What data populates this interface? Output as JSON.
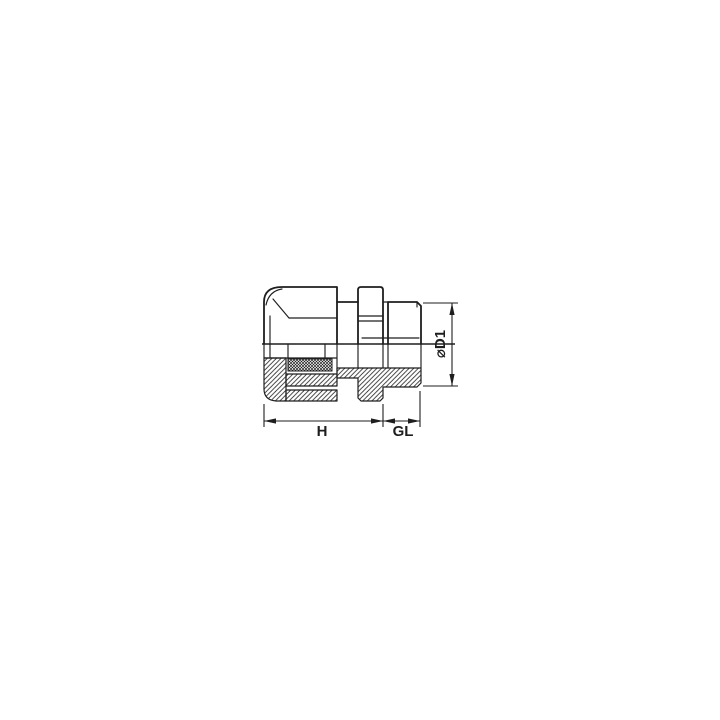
{
  "page": {
    "background": "#ffffff"
  },
  "drawing": {
    "type": "technical-half-section-drawing",
    "subject": "cable-gland-cross-section",
    "line_color": "#1e1e1e",
    "dimension_labels": {
      "body_length": "H",
      "thread_length": "GL",
      "thread_diameter": "⌀D1"
    }
  }
}
